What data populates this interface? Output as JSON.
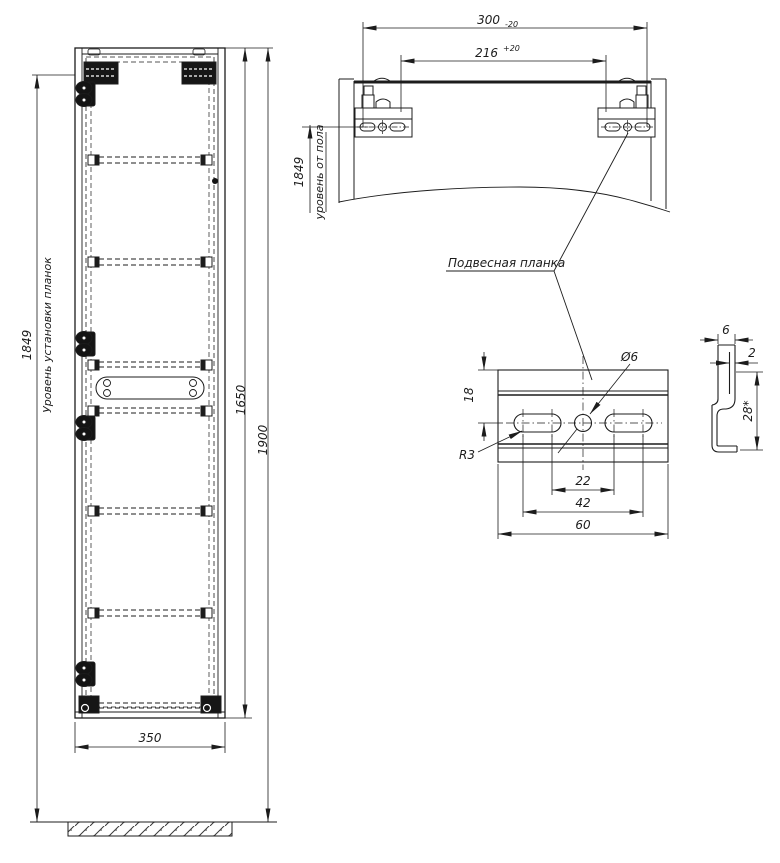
{
  "front_view": {
    "strip_level_value": "1849",
    "strip_level_label": "Уровень установки планок",
    "cabinet_height": "1650",
    "top_height": "1900",
    "width": "350"
  },
  "top_view": {
    "outer_span": "300",
    "outer_span_tolerance": "-20",
    "inner_span": "216",
    "inner_span_tolerance": "+20",
    "floor_level_value": "1849",
    "floor_level_label": "уровень от пола",
    "callout": "Подвесная планка"
  },
  "strip_detail": {
    "edge_to_holes": "18",
    "hole_diameter": "Ø6",
    "slot_radius": "R3",
    "slot_inner_span": "22",
    "slot_outer_span": "42",
    "strip_width": "60"
  },
  "strip_side": {
    "hook_depth": "6",
    "thickness": "2",
    "height": "28*"
  }
}
